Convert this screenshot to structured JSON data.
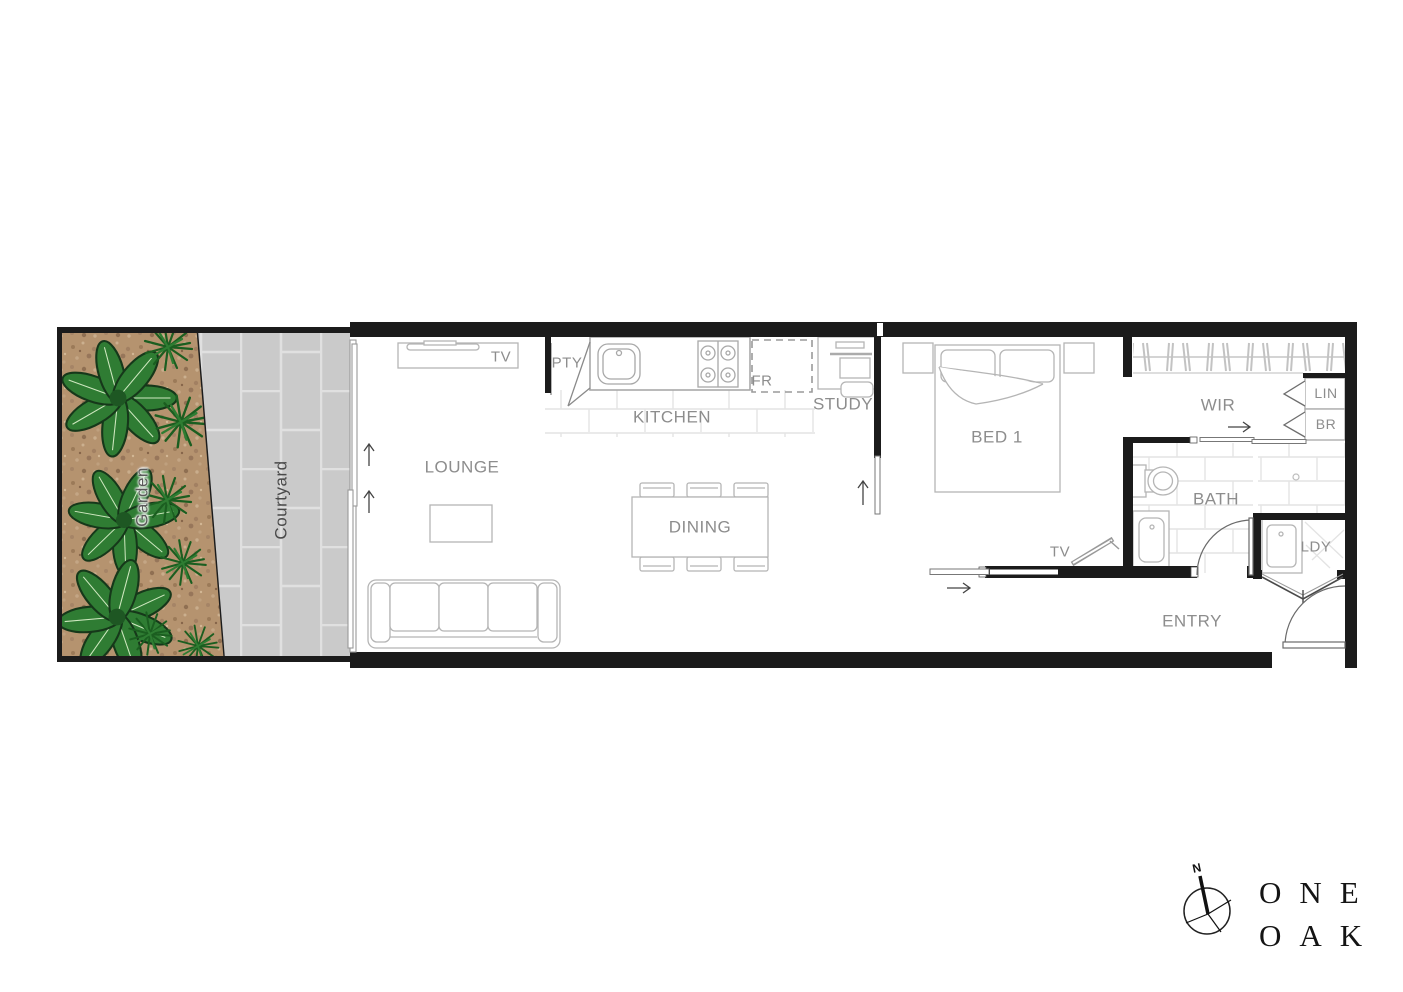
{
  "plan": {
    "outdoor": {
      "garden": "Garden",
      "courtyard": "Courtyard"
    },
    "rooms": {
      "lounge": "LOUNGE",
      "kitchen": "KITCHEN",
      "dining": "DINING",
      "study": "STUDY",
      "bed1": "BED 1",
      "wir": "WIR",
      "bath": "BATH",
      "laundry": "LDY",
      "entry": "ENTRY"
    },
    "fixtures": {
      "tv_lounge": "TV",
      "pantry": "PTY",
      "fridge": "FR",
      "tv_bed": "TV",
      "linen": "LIN",
      "broom": "BR"
    }
  },
  "compass": {
    "north": "N"
  },
  "logo": {
    "line1": "ONE",
    "line2": "OAK"
  },
  "colors": {
    "wall": "#1b1b1b",
    "furniture_line": "#b5b5b5",
    "label_text": "#8d8d8d",
    "courtyard_paving": "#cacaca",
    "paving_grout": "#e0e0e0",
    "garden_soil": "#b5936f",
    "plant_leaf": "#2f7c33",
    "plant_spiky": "#1b5e20"
  }
}
